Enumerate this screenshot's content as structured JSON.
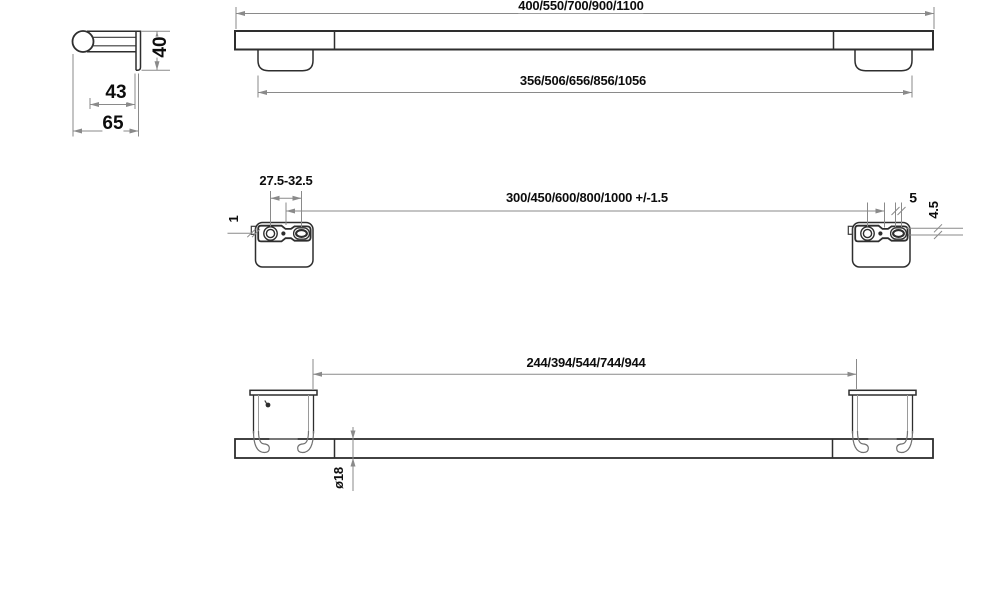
{
  "drawing": {
    "type": "technical-drawing",
    "product": "wall-mounted towel bar with mounting brackets",
    "colors": {
      "background": "#ffffff",
      "object_line": "#2e2e2e",
      "dimension_line": "#8a8a8a",
      "text": "#0d0d0d"
    },
    "views": {
      "side": {
        "name": "side view of bracket and bar",
        "dims": {
          "bracket_depth": "43",
          "total_depth": "65",
          "height": "40"
        }
      },
      "front": {
        "name": "front elevation of bar",
        "dims": {
          "overall_length": "400/550/700/900/1100",
          "bracket_outer_span": "356/506/656/856/1056"
        }
      },
      "mounting": {
        "name": "wall plate face views",
        "dims": {
          "slot_adjust_range": "27.5-32.5",
          "hole_center_distance": "300/450/600/800/1000 +/-1.5",
          "plate_tab": "1",
          "slot_offset": "5",
          "slot_height": "4.5"
        }
      },
      "plan": {
        "name": "plan view of bar",
        "dims": {
          "clear_span": "244/394/544/744/944",
          "bar_diameter": "ø18"
        }
      }
    }
  }
}
